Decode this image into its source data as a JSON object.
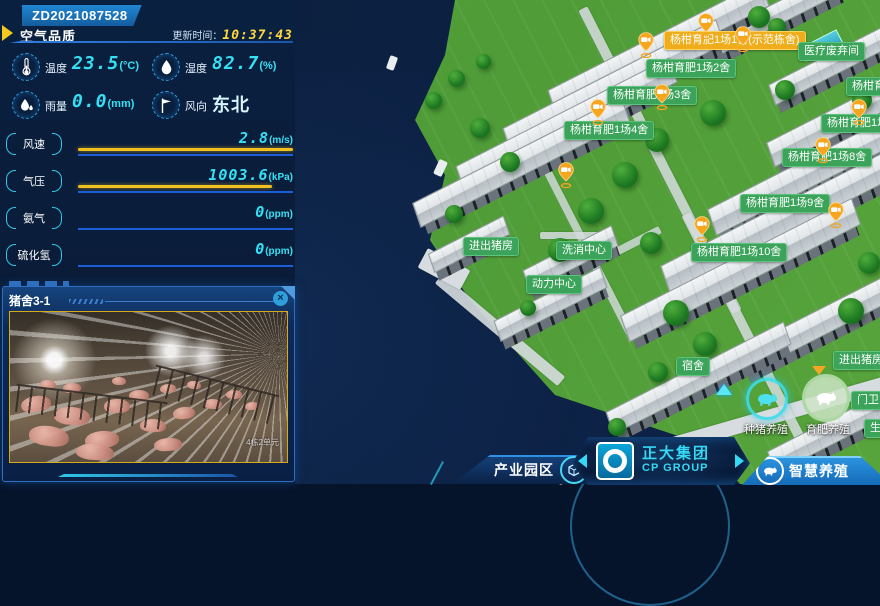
{
  "device_badge": "ZD2021087528",
  "colors": {
    "accent_cyan": "#35e0f5",
    "accent_yellow": "#ffd83d",
    "bar_yellow": "#f0c01f",
    "bar_blue": "#1d5dd8",
    "label_green": "#3ba45a",
    "label_orange": "#f0ad1b",
    "marker_orange": "#f6a51f"
  },
  "air_panel": {
    "title": "空气品质",
    "update_label": "更新时间：",
    "update_time": "10:37:43",
    "metrics": [
      {
        "icon": "thermometer-icon",
        "label": "温度",
        "value": "23.5",
        "unit": "(°C)",
        "digital": true
      },
      {
        "icon": "humidity-drop-icon",
        "label": "湿度",
        "value": "82.7",
        "unit": "(%)",
        "digital": true
      },
      {
        "icon": "rain-drop-icon",
        "label": "雨量",
        "value": "0.0",
        "unit": "(mm)",
        "digital": true
      },
      {
        "icon": "wind-flag-icon",
        "label": "风向",
        "value": "东北",
        "unit": "",
        "digital": false
      }
    ],
    "gauges": [
      {
        "label": "风速",
        "value": "2.8",
        "unit": "(m/s)",
        "fill": 100
      },
      {
        "label": "气压",
        "value": "1003.6",
        "unit": "(kPa)",
        "fill": 90
      },
      {
        "label": "氨气",
        "value": "0",
        "unit": "(ppm)",
        "fill": 0
      },
      {
        "label": "硫化氢",
        "value": "0",
        "unit": "(ppm)",
        "fill": 0
      }
    ]
  },
  "camera_panel": {
    "title": "猪舍3-1",
    "close_icon": "close-icon",
    "watermark": "4栋2单元"
  },
  "map": {
    "marker_icon": "camera-pin-icon",
    "labels": [
      {
        "text": "杨柑育肥1场1舍(示范栋舍)",
        "color": "orange",
        "x": 664,
        "y": 31
      },
      {
        "text": "医疗废弃间",
        "color": "green",
        "x": 798,
        "y": 42
      },
      {
        "text": "杨柑育肥1场2舍",
        "color": "green",
        "x": 646,
        "y": 59
      },
      {
        "text": "杨柑育肥1场6舍",
        "color": "green",
        "x": 846,
        "y": 77
      },
      {
        "text": "杨柑育肥1场3舍",
        "color": "green",
        "x": 607,
        "y": 86
      },
      {
        "text": "杨柑育肥1场7舍",
        "color": "green",
        "x": 821,
        "y": 114
      },
      {
        "text": "杨柑育肥1场4舍",
        "color": "green",
        "x": 564,
        "y": 121
      },
      {
        "text": "杨柑育肥1场8舍",
        "color": "green",
        "x": 782,
        "y": 148
      },
      {
        "text": "杨柑育肥1场9舍",
        "color": "green",
        "x": 740,
        "y": 194
      },
      {
        "text": "杨柑育肥1场10舍",
        "color": "green",
        "x": 691,
        "y": 243
      },
      {
        "text": "进出猪房",
        "color": "green",
        "x": 463,
        "y": 237
      },
      {
        "text": "洗消中心",
        "color": "green",
        "x": 556,
        "y": 241
      },
      {
        "text": "动力中心",
        "color": "green",
        "x": 526,
        "y": 275
      },
      {
        "text": "宿舍",
        "color": "green",
        "x": 676,
        "y": 357
      },
      {
        "text": "进出猪房",
        "color": "green",
        "x": 833,
        "y": 351
      },
      {
        "text": "门卫",
        "color": "green",
        "x": 851,
        "y": 391
      },
      {
        "text": "生活区",
        "color": "green",
        "x": 864,
        "y": 419
      }
    ],
    "markers": [
      {
        "x": 698,
        "y": 13
      },
      {
        "x": 735,
        "y": 26
      },
      {
        "x": 638,
        "y": 32
      },
      {
        "x": 654,
        "y": 84
      },
      {
        "x": 558,
        "y": 162
      },
      {
        "x": 590,
        "y": 99
      },
      {
        "x": 851,
        "y": 99
      },
      {
        "x": 815,
        "y": 137
      },
      {
        "x": 828,
        "y": 202
      },
      {
        "x": 694,
        "y": 216
      }
    ],
    "poi": [
      {
        "icon": "breeding-pig-icon",
        "text": "种猪养殖",
        "x": 744,
        "y": 421
      },
      {
        "icon": "fattening-pig-icon",
        "text": "育肥养殖",
        "x": 806,
        "y": 421
      }
    ]
  },
  "bottom_nav": {
    "park_tab": {
      "label": "产业园区",
      "icon": "industry-park-icon"
    },
    "brand": {
      "name": "正大集团",
      "sub": "CP GROUP",
      "icon": "cp-group-logo"
    },
    "smart_tab": {
      "label": "智慧养殖",
      "icon": "smart-farming-pig-icon"
    }
  }
}
